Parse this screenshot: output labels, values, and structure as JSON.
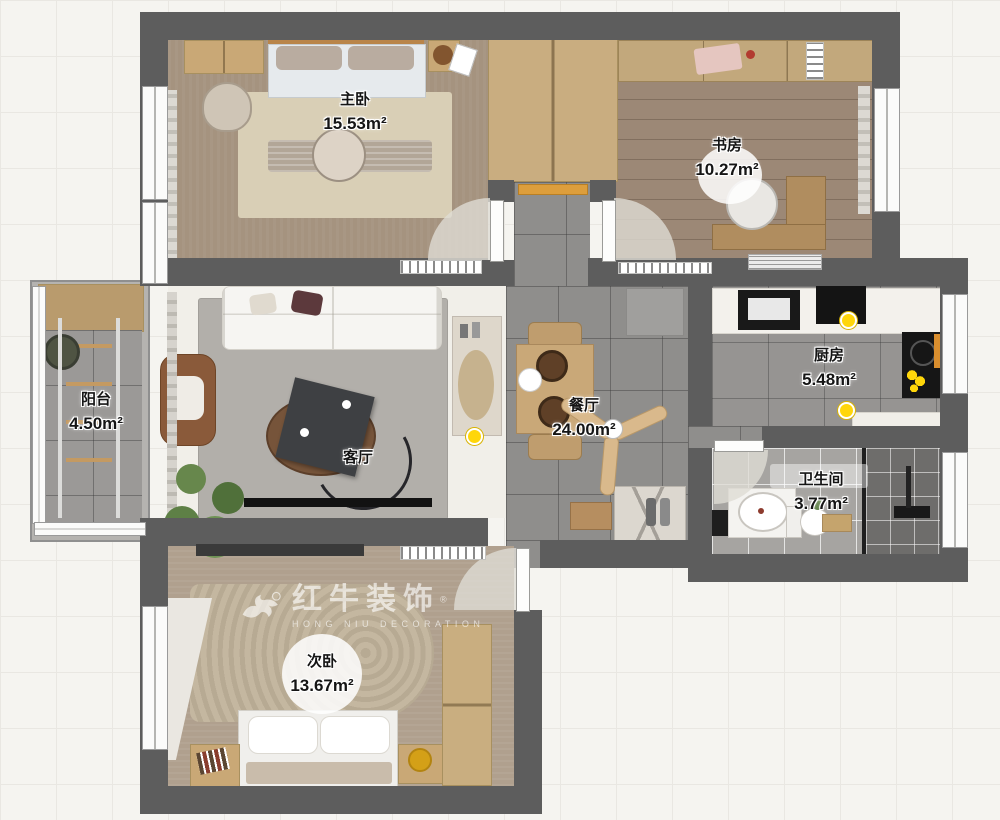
{
  "watermark": {
    "brand": "红牛装饰",
    "subtitle": "HONG NIU DECORATION",
    "registered": "®"
  },
  "rooms": [
    {
      "id": "master-bedroom",
      "label": "主卧",
      "area": "15.53m²"
    },
    {
      "id": "study",
      "label": "书房",
      "area": "10.27m²"
    },
    {
      "id": "balcony",
      "label": "阳台",
      "area": "4.50m²"
    },
    {
      "id": "living-room",
      "label": "客厅",
      "area": ""
    },
    {
      "id": "dining-room",
      "label": "餐厅",
      "area": "24.00m²"
    },
    {
      "id": "kitchen",
      "label": "厨房",
      "area": "5.48m²"
    },
    {
      "id": "bathroom",
      "label": "卫生间",
      "area": "3.77m²"
    },
    {
      "id": "second-bedroom",
      "label": "次卧",
      "area": "13.67m²"
    }
  ],
  "colors": {
    "wall": "#5d5d5d",
    "accent_yellow": "#ffd60a",
    "threshold_orange": "#dd9e3c"
  }
}
